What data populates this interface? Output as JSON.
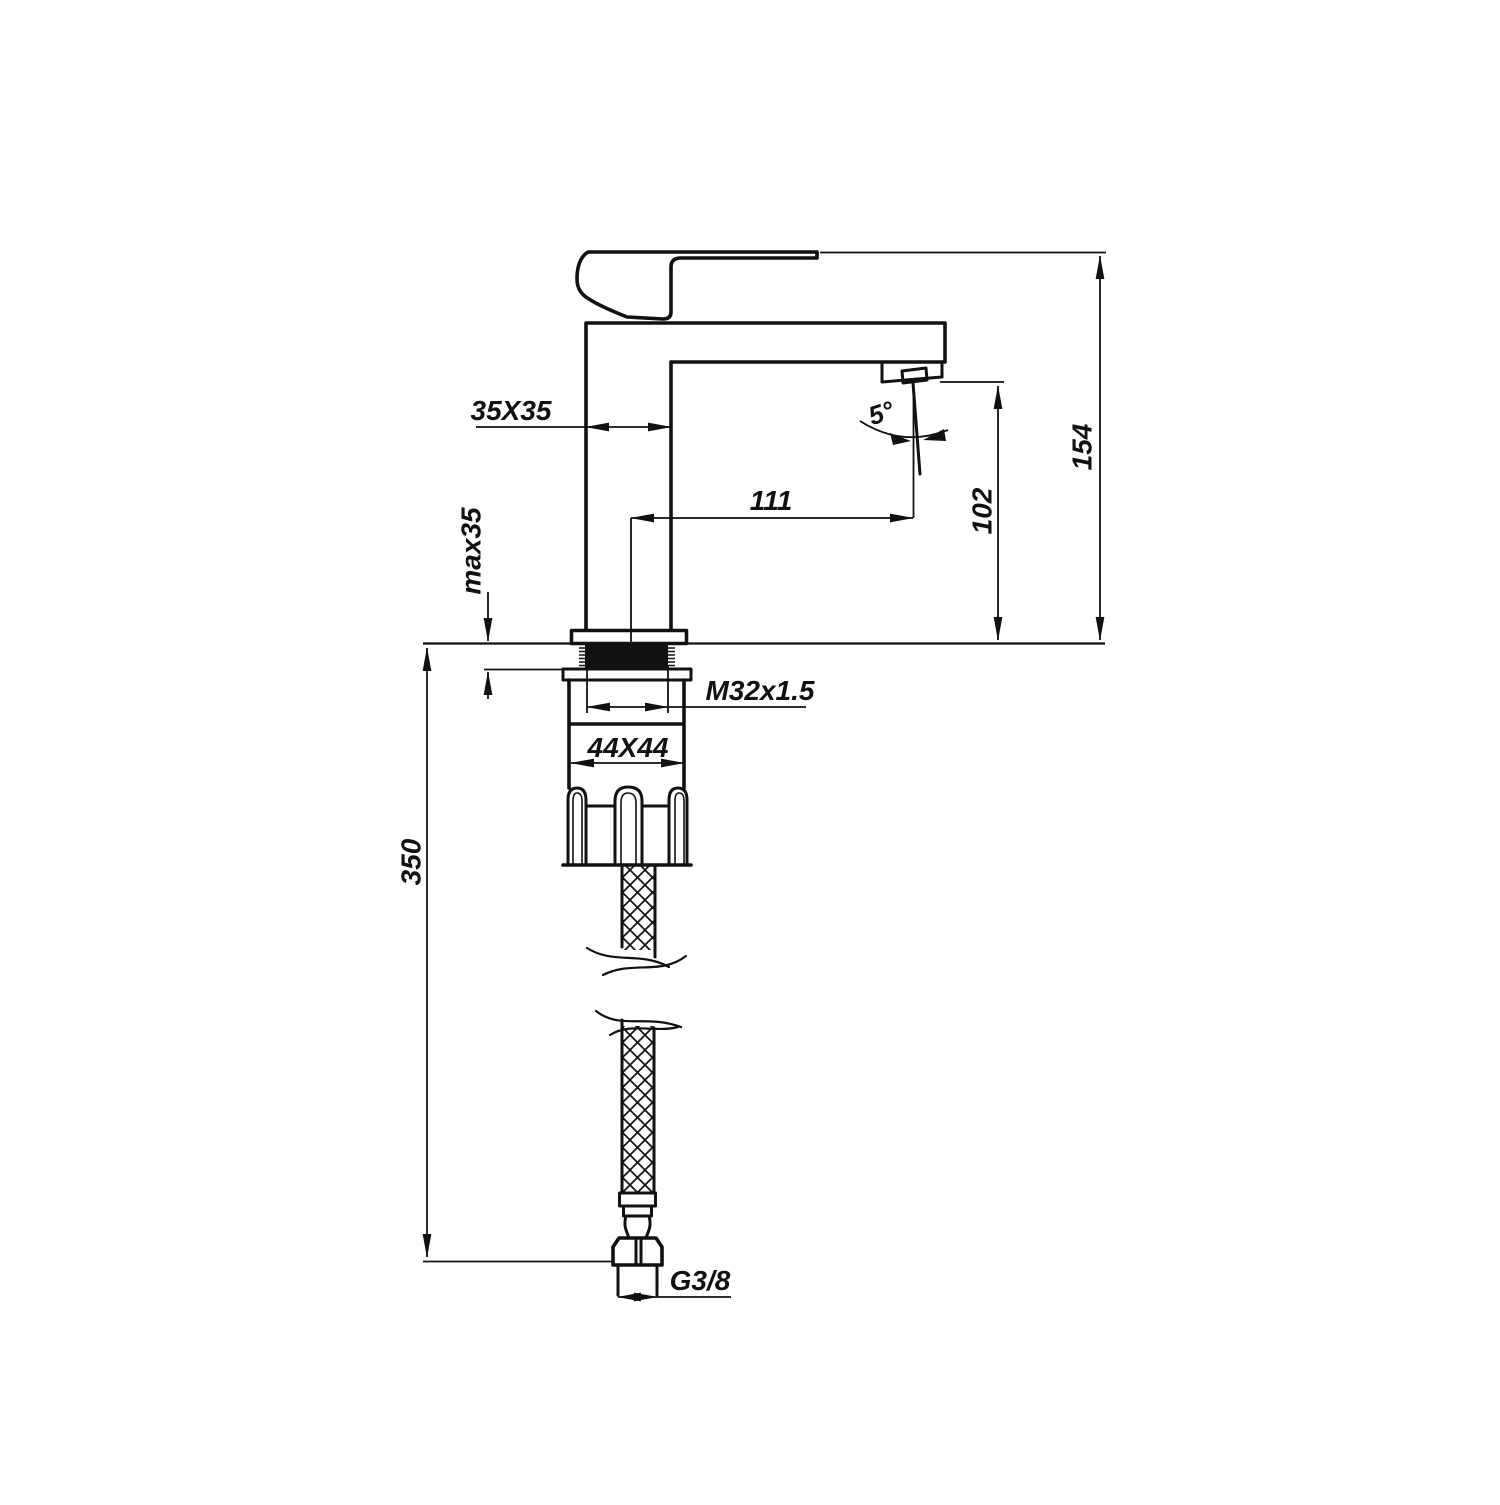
{
  "colors": {
    "ink": "#111111",
    "paper": "#ffffff"
  },
  "diagram": {
    "kind": "technical-drawing",
    "labels": {
      "body_section": "35X35",
      "max_deck_thickness": "max35",
      "spout_reach": "111",
      "spout_outlet_height": "102",
      "overall_height": "154",
      "stream_angle": "5°",
      "mounting_thread": "M32x1.5",
      "base_section": "44X44",
      "hose_length": "350",
      "hose_connector": "G3/8"
    }
  }
}
